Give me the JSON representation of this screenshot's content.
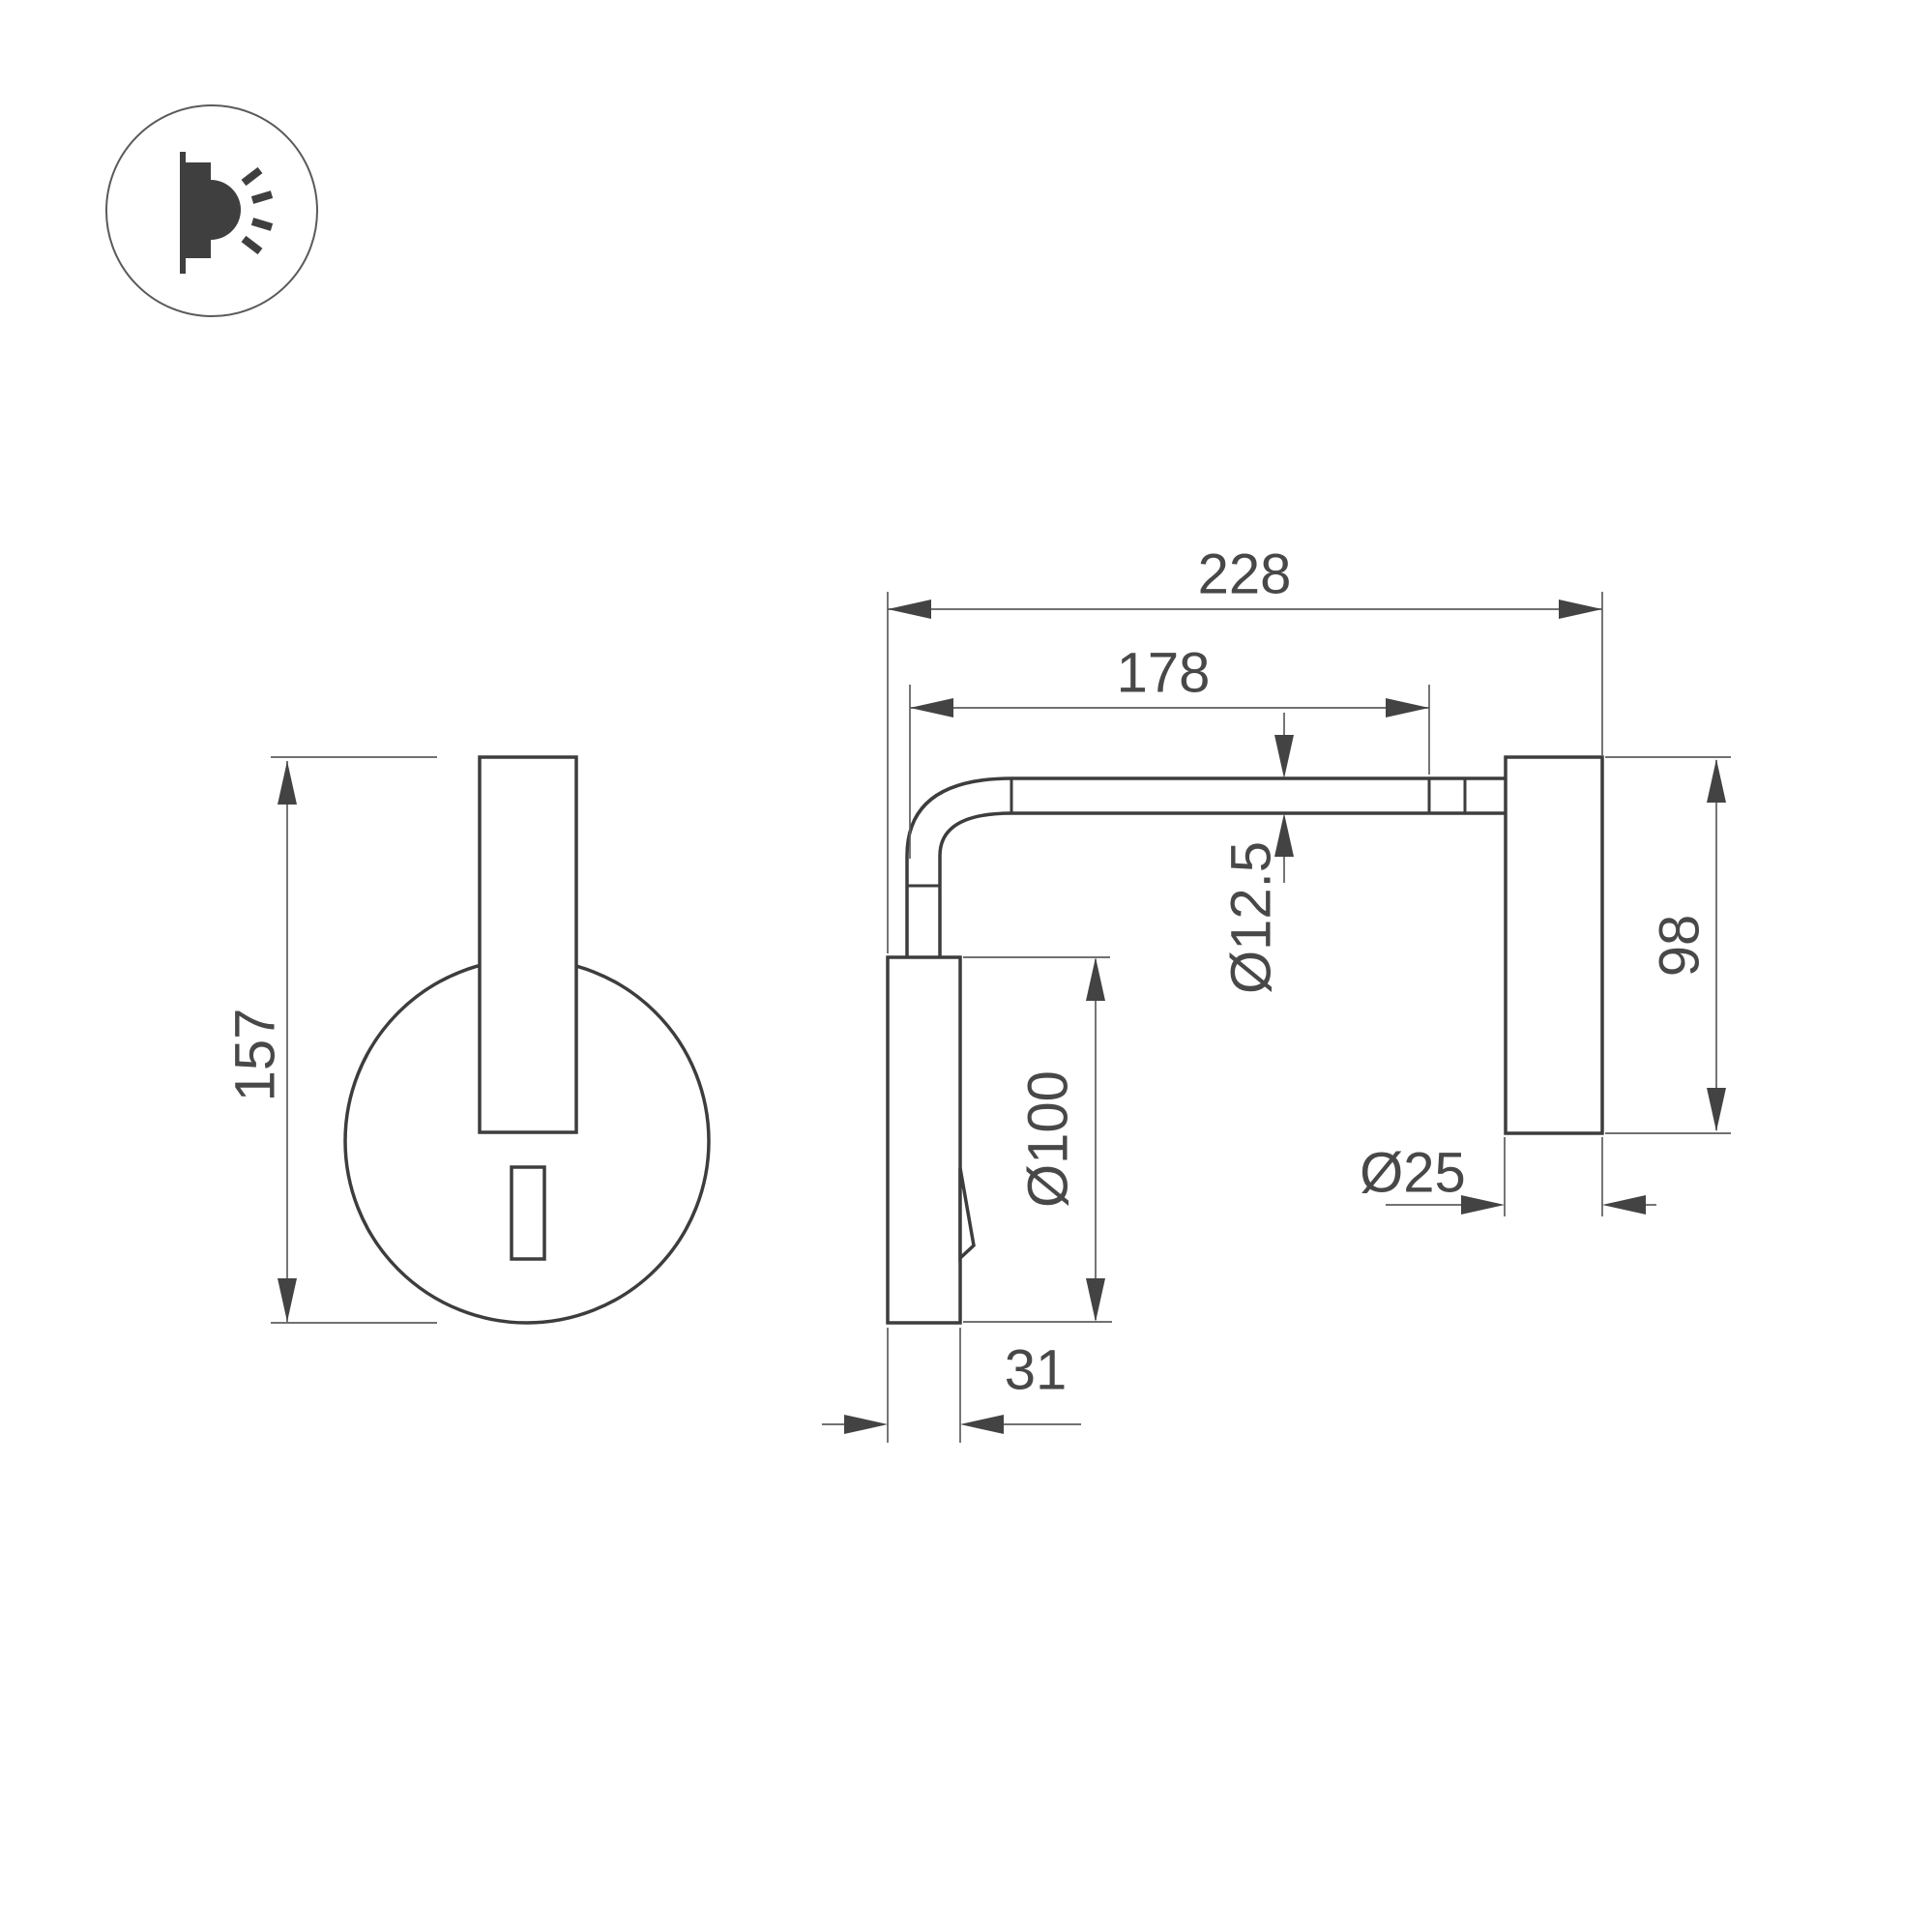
{
  "drawing": {
    "type": "technical-dimension-drawing",
    "subject": "wall-mounted-reading-lamp",
    "colors": {
      "background": "#ffffff",
      "object_line": "#3d3d3d",
      "dimension_line": "#5d5d5d",
      "arrow": "#434343",
      "text": "#484848"
    }
  },
  "logo": {
    "icon": "wall-light-icon"
  },
  "front_view": {
    "dim_overall_height": "157"
  },
  "side_view": {
    "dim_total_depth": "228",
    "dim_arm_length": "178",
    "dim_arm_diameter": "Ø12.5",
    "dim_base_diameter": "Ø100",
    "dim_head_height": "98",
    "dim_head_diameter": "Ø25",
    "dim_base_depth": "31"
  }
}
